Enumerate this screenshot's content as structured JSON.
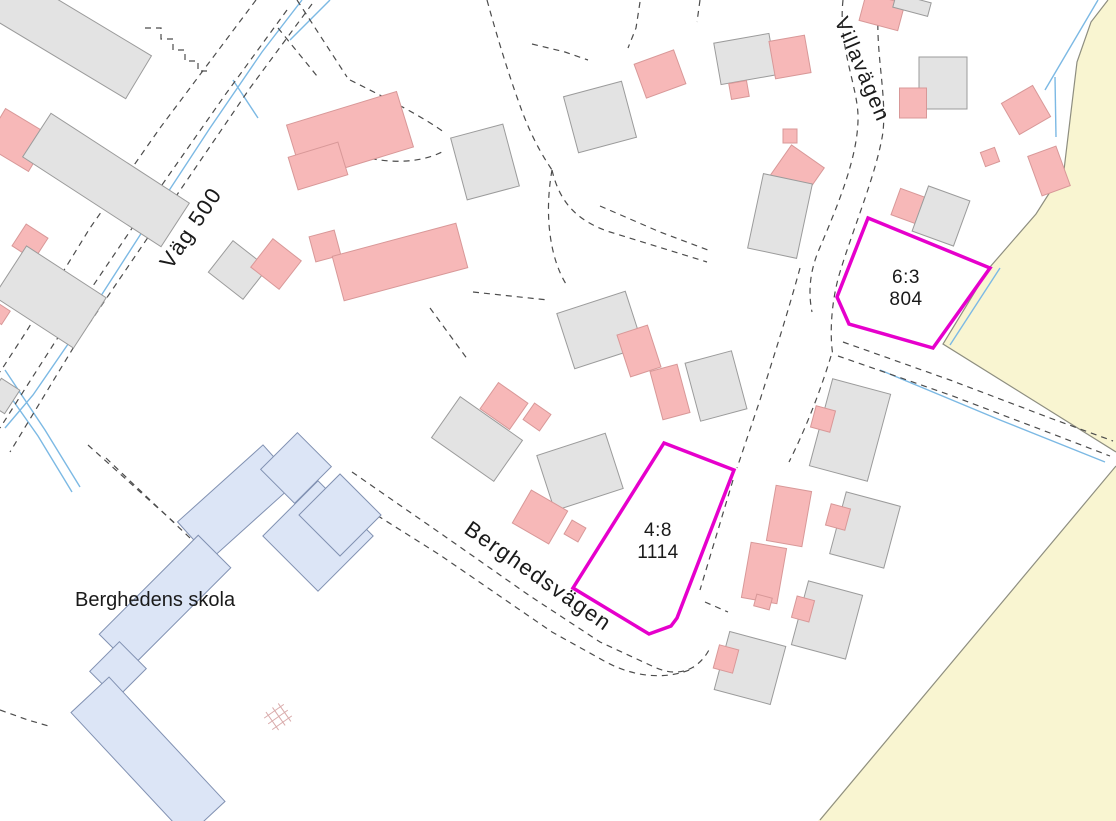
{
  "map": {
    "labels": {
      "road_vag500": "Väg 500",
      "road_villavagen": "Villavägen",
      "road_berghedsvagen": "Berghedsvägen",
      "school": "Berghedens skola",
      "parcel_63_designation": "6:3",
      "parcel_63_number": "804",
      "parcel_48_designation": "4:8",
      "parcel_48_number": "1114"
    },
    "colors": {
      "background": "#ffffff",
      "field_fill": "#f9f5d1",
      "building_gray_fill": "#e3e3e3",
      "building_gray_stroke": "#9b9b9b",
      "building_pink_fill": "#f7b8b8",
      "building_pink_stroke": "#d89898",
      "school_fill": "#dce5f6",
      "school_stroke": "#8191b2",
      "parcel_stroke": "#e600cc",
      "stream": "#7cb9e4",
      "dash_line": "#4c4c4c",
      "boundary_line": "#8e8e80",
      "lattice_stroke": "#d9abab",
      "text": "#1a1a1a"
    },
    "fields": [
      "1108,0 1091,22 1077,62 1064,170 1036,214 990,267 943,344 1116,452 1116,0",
      "1116,466 1116,821 818,821"
    ],
    "solid_lines": [
      "M1108,0 L1091,22 L1077,62 L1064,170 L1036,214 L990,267 L943,344 L1116,452",
      "M1116,466 L820,820"
    ],
    "streams": [
      "M302,0 L262,52 L210,128 L153,215 L97,302 L33,395 L5,428",
      "M5,370 L45,430 L80,487",
      "M0,382 L38,436 L72,492",
      "M330,0 L290,40",
      "M233,80 L258,118",
      "M1098,0 L1045,90",
      "M1055,77 L1056,137",
      "M880,370 L1000,420 L1105,462",
      "M1000,268 L950,345"
    ],
    "dashed_lines": [
      "M256,0 L160,128 L90,228 L26,332 L0,372",
      "M287,10 L225,95 L143,212 L55,342 L0,428",
      "M312,4 L250,88 L168,208 L78,340 L10,452",
      "M145,28 L161,28 L161,39 L173,39 L173,50 L185,50 L185,61 L198,61 L198,71 L209,71",
      "M297,0 L347,77",
      "M278,28 L317,76",
      "M350,80 C390,100 425,118 445,133",
      "M360,156 C390,164 420,163 442,152",
      "M487,0 C498,40 508,72 518,100 C530,135 542,155 552,170",
      "M532,44 L565,52 L588,60",
      "M640,2 L636,28 L628,48",
      "M700,0 L697,22",
      "M552,170 C560,205 580,222 610,232 L707,262",
      "M600,206 L660,232 L708,250",
      "M552,170 C544,215 550,258 566,284",
      "M473,292 L548,300",
      "M430,308 L468,360",
      "M843,0 C838,45 857,85 858,115 C859,155 838,205 818,252 C810,272 808,292 812,312",
      "M879,2 C874,48 887,92 883,132 C877,172 854,226 840,272 C832,298 829,332 833,356",
      "M800,268 C788,312 774,356 760,400 L737,468",
      "M831,356 C820,392 806,428 789,462",
      "M843,342 L950,380 L1050,418 L1113,441",
      "M838,356 L950,395 L1050,433 L1110,456",
      "M733,480 L700,590",
      "M352,472 L440,533 L530,596 L600,642 L652,666 C680,680 700,668 710,648",
      "M340,492 L440,555 L552,632 L606,662 C636,678 668,680 694,668",
      "M705,602 L728,612",
      "M88,445 L178,526",
      "M106,458 L190,538",
      "M0,710 L28,720 L52,727"
    ],
    "buildings": [
      [
        "g",
        70,
        36,
        160,
        50,
        31
      ],
      [
        "p",
        17,
        140,
        52,
        42,
        31
      ],
      [
        "g",
        106,
        180,
        165,
        52,
        33
      ],
      [
        "p",
        30,
        242,
        26,
        26,
        33
      ],
      [
        "g",
        50,
        297,
        95,
        60,
        33
      ],
      [
        "g",
        3,
        396,
        22,
        28,
        33
      ],
      [
        "p",
        0,
        314,
        14,
        16,
        33
      ],
      [
        "g",
        238,
        270,
        44,
        40,
        38
      ],
      [
        "p",
        276,
        264,
        36,
        36,
        38
      ],
      [
        "p",
        350,
        136,
        115,
        58,
        -17
      ],
      [
        "p",
        318,
        166,
        52,
        34,
        -17
      ],
      [
        "p",
        325,
        246,
        26,
        26,
        -15
      ],
      [
        "p",
        400,
        262,
        128,
        46,
        -15
      ],
      [
        "g",
        485,
        162,
        54,
        64,
        -15
      ],
      [
        "p",
        660,
        74,
        42,
        36,
        -20
      ],
      [
        "g",
        600,
        117,
        60,
        58,
        -15
      ],
      [
        "g",
        745,
        59,
        56,
        42,
        -10
      ],
      [
        "p",
        790,
        57,
        36,
        38,
        -10
      ],
      [
        "p",
        739,
        90,
        18,
        16,
        -10
      ],
      [
        "p",
        790,
        136,
        14,
        14,
        0
      ],
      [
        "p",
        797,
        172,
        40,
        38,
        35
      ],
      [
        "g",
        780,
        216,
        50,
        76,
        12
      ],
      [
        "p",
        882,
        12,
        40,
        28,
        15
      ],
      [
        "g",
        912,
        5,
        36,
        14,
        15
      ],
      [
        "g",
        943,
        83,
        48,
        52,
        0
      ],
      [
        "p",
        913,
        103,
        27,
        30,
        0
      ],
      [
        "p",
        1026,
        110,
        36,
        36,
        -30
      ],
      [
        "p",
        990,
        157,
        15,
        15,
        -20
      ],
      [
        "p",
        1049,
        171,
        30,
        42,
        -20
      ],
      [
        "p",
        908,
        206,
        26,
        28,
        20
      ],
      [
        "g",
        941,
        216,
        44,
        48,
        20
      ],
      [
        "g",
        600,
        330,
        72,
        58,
        -18
      ],
      [
        "p",
        639,
        351,
        32,
        44,
        -18
      ],
      [
        "p",
        670,
        392,
        28,
        50,
        -15
      ],
      [
        "g",
        716,
        386,
        48,
        60,
        -15
      ],
      [
        "p",
        504,
        406,
        36,
        32,
        35
      ],
      [
        "g",
        477,
        439,
        76,
        50,
        35
      ],
      [
        "p",
        537,
        417,
        20,
        20,
        35
      ],
      [
        "g",
        580,
        472,
        72,
        58,
        -18
      ],
      [
        "p",
        540,
        517,
        42,
        38,
        30
      ],
      [
        "p",
        575,
        531,
        16,
        16,
        30
      ],
      [
        "g",
        850,
        430,
        60,
        90,
        15
      ],
      [
        "p",
        823,
        419,
        20,
        22,
        15
      ],
      [
        "p",
        789,
        516,
        36,
        56,
        10
      ],
      [
        "g",
        865,
        530,
        56,
        64,
        15
      ],
      [
        "p",
        838,
        517,
        20,
        22,
        15
      ],
      [
        "p",
        764,
        573,
        36,
        56,
        10
      ],
      [
        "g",
        827,
        620,
        56,
        66,
        15
      ],
      [
        "p",
        803,
        609,
        18,
        22,
        15
      ],
      [
        "p",
        763,
        602,
        16,
        12,
        15
      ],
      [
        "g",
        750,
        668,
        58,
        60,
        15
      ],
      [
        "p",
        726,
        659,
        20,
        24,
        15
      ]
    ],
    "school_blocks": [
      [
        237,
        502,
        115,
        50,
        -42
      ],
      [
        296,
        468,
        52,
        48,
        -45
      ],
      [
        318,
        536,
        78,
        78,
        45
      ],
      [
        340,
        515,
        58,
        58,
        45
      ],
      [
        165,
        601,
        140,
        46,
        -45
      ],
      [
        118,
        670,
        42,
        38,
        -45
      ],
      [
        148,
        757,
        170,
        52,
        47
      ]
    ],
    "lattice": {
      "cx": 278,
      "cy": 717,
      "rot": -35,
      "lines": [
        "M-12,-7 L12,-7",
        "M-12,0 L12,0",
        "M-12,7 L12,7",
        "M-7,-11 L-7,11",
        "M1,-11 L1,11",
        "M8,-11 L8,11"
      ]
    },
    "parcels": [
      {
        "id": "6-3",
        "points": "868,218 990,268 933,348 849,324 837,297"
      },
      {
        "id": "4-8",
        "points": "664,443 734,470 677,618 671,626 649,634 573,588"
      }
    ]
  }
}
